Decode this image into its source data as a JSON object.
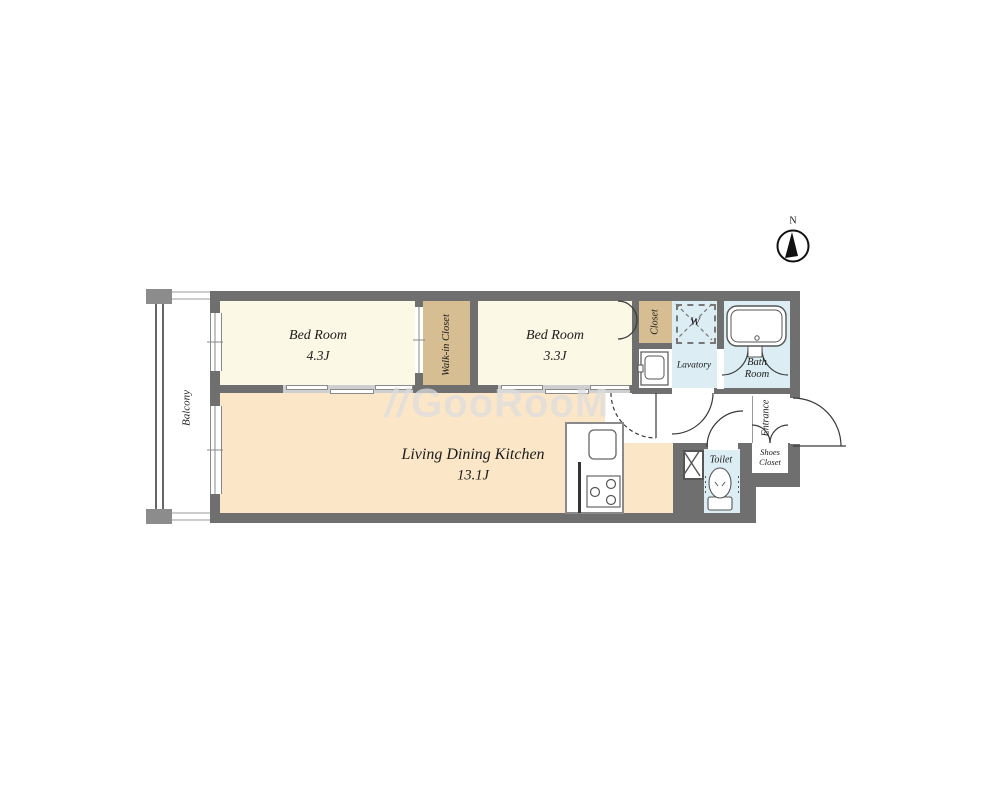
{
  "compass": {
    "label": "N"
  },
  "watermark": {
    "icon": "//",
    "label": "GooRooM"
  },
  "rooms": {
    "balcony": {
      "label": "Balcony"
    },
    "bedroom1": {
      "label": "Bed Room",
      "size": "4.3J"
    },
    "walk_in_closet": {
      "label": "Walk-in Closet"
    },
    "bedroom2": {
      "label": "Bed Room",
      "size": "3.3J"
    },
    "closet": {
      "label": "Closet"
    },
    "washer": {
      "label": "W"
    },
    "lavatory": {
      "label": "Lavatory"
    },
    "bathroom": {
      "label": "Bath Room"
    },
    "ldk": {
      "label": "Living Dining Kitchen",
      "size": "13.1J"
    },
    "toilet": {
      "label": "Toilet"
    },
    "entrance": {
      "label": "Entrance"
    },
    "shoes_closet": {
      "label": "Shoes Closet"
    }
  },
  "colors": {
    "wall": "#6F6F6F",
    "bedroom_floor": "#FBF8E5",
    "ldk_floor": "#FBE7C8",
    "closet_floor": "#D7BD92",
    "wet_floor": "#DCEEF4",
    "opening_strip": "#CFCFCF",
    "watermark": "#DCDCDC"
  }
}
